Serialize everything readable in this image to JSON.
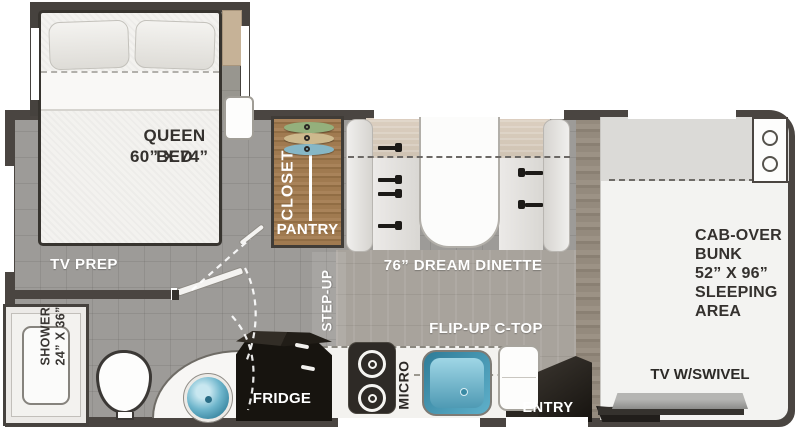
{
  "bedroom": {
    "bed_line1": "QUEEN BED",
    "bed_line2": "60” X 74”",
    "tv_prep": "TV PREP"
  },
  "bathroom": {
    "shower_line1": "SHOWER",
    "shower_line2": "24” X 36”"
  },
  "storage": {
    "closet": "CLOSET",
    "pantry": "PANTRY"
  },
  "living": {
    "dinette": "76” DREAM DINETTE",
    "step_up": "STEP-UP"
  },
  "kitchen": {
    "fridge": "FRIDGE",
    "micro": "MICRO",
    "flip_up_ctop": "FLIP-UP C-TOP"
  },
  "entry": {
    "label": "ENTRY"
  },
  "cab": {
    "bunk_line1": "CAB-OVER",
    "bunk_line2": "BUNK",
    "bunk_line3": "52” X 96”",
    "bunk_line4": "SLEEPING",
    "bunk_line5": "AREA",
    "tv": "TV W/SWIVEL"
  },
  "colors": {
    "wall": "#4a4541",
    "floor_gray": "#9d9b98",
    "closet_wood": "#a07a50",
    "appliance_black": "#17140f",
    "sink_teal": "#5fb0ca",
    "hanger_green": "#94b07c",
    "hanger_tan": "#cdb98d",
    "hanger_blue": "#86b7c6",
    "fabric_white": "#f3f2ef"
  }
}
